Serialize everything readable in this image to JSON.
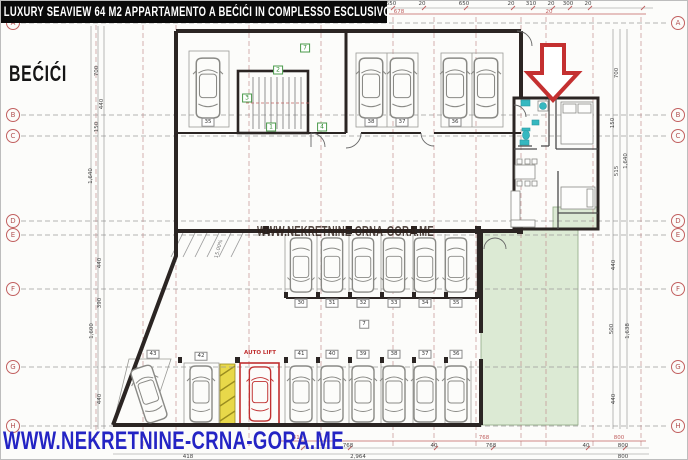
{
  "banner": {
    "title": "LUXURY SEAVIEW 64 M2 APPARTAMENTO A BEĆIĆI IN COMPLESSO ESCLUSIVO"
  },
  "location_label": "BEĆIĆI",
  "website": "WWW.NEKRETNINE-CRNA-GORA.ME",
  "colors": {
    "banner_bg": "#0a0a0a",
    "banner_text": "#ffffff",
    "website_blue": "#2424c4",
    "arrow_red": "#c43030",
    "green_area": "#dcead4",
    "yellow_strip": "#e8d84a",
    "cyan_fixture": "#35b8c0",
    "dim_red": "#c06060",
    "wall_dark": "#2b2523",
    "lift_red": "#c03030"
  },
  "grid": {
    "rows": [
      {
        "label": "A"
      },
      {
        "label": "B"
      },
      {
        "label": "C"
      },
      {
        "label": "D"
      },
      {
        "label": "E"
      },
      {
        "label": "F"
      },
      {
        "label": "G"
      },
      {
        "label": "H"
      }
    ]
  },
  "plan": {
    "labels": {
      "auto_lift": "AUTO LIFT",
      "ramp_slope": "15.00%",
      "zone_top": "7",
      "zone_mid": "7"
    },
    "stair_labels": [
      "2",
      "3",
      "1",
      "4"
    ],
    "parking": {
      "top_row": [
        "35",
        "38",
        "37",
        "36"
      ],
      "middle_row": [
        "30",
        "31",
        "32",
        "33",
        "34",
        "35"
      ],
      "bottom_left": [
        "43",
        "42"
      ],
      "bottom_row": [
        "41",
        "40",
        "39",
        "38",
        "37",
        "36"
      ]
    }
  },
  "dimensions": {
    "top": [
      "20",
      "450",
      "20",
      "650",
      "20",
      "650",
      "20",
      "310",
      "20",
      "300",
      "20"
    ],
    "top_red": [
      "678",
      "20"
    ],
    "bottom_red": [
      "410",
      "768",
      "800"
    ],
    "bottom_mid": [
      "768",
      "40",
      "768",
      "40",
      "800"
    ],
    "bottom_low": [
      "418",
      "2,964",
      "800"
    ],
    "left": [
      "700",
      "440",
      "150",
      "1,640",
      "440",
      "390",
      "1,600",
      "440"
    ],
    "right": [
      "700",
      "150",
      "515",
      "1,640",
      "440",
      "500",
      "1,638",
      "440"
    ]
  }
}
